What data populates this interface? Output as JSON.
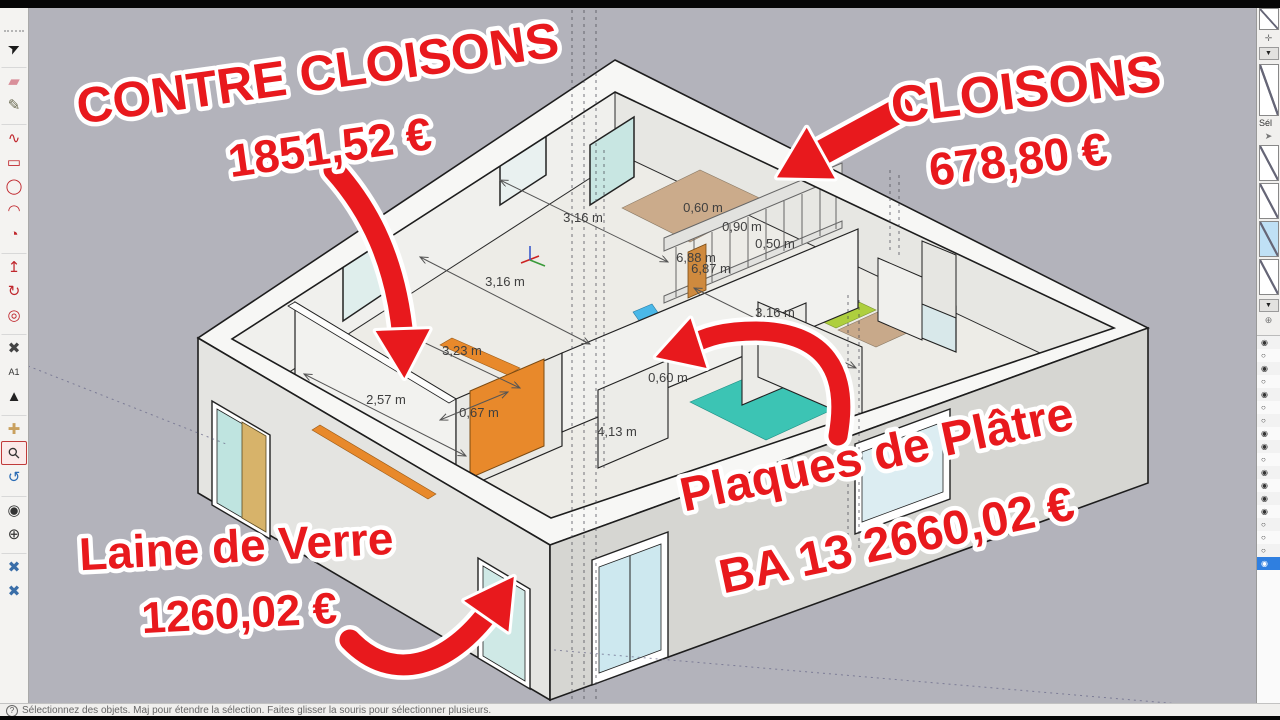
{
  "app": {
    "name": "SketchUp viewport",
    "viewport_bg": "#b3b3bb"
  },
  "colors": {
    "annotation_red": "#e8191d",
    "door_orange": "#e8892b",
    "floor_teal": "#3cc4b4",
    "floor_green": "#aecf3e",
    "floor_tan": "#cbab8b",
    "glass_blue": "#cfe9ec",
    "active_row_blue": "#2f7fe0"
  },
  "annotations": {
    "contre": {
      "title": "CONTRE CLOISONS",
      "price": "1851,52 €"
    },
    "cloisons": {
      "title": "CLOISONS",
      "price": "678,80 €"
    },
    "plaques": {
      "title": "Plaques de Plâtre",
      "price": "BA 13 2660,02 €"
    },
    "laine": {
      "title": "Laine de Verre",
      "price": "1260,02 €"
    }
  },
  "dimensions": [
    {
      "label": "3,16 m",
      "x": 583,
      "y": 222
    },
    {
      "label": "3,16 m",
      "x": 505,
      "y": 286
    },
    {
      "label": "3,16 m",
      "x": 775,
      "y": 317
    },
    {
      "label": "0,60 m",
      "x": 703,
      "y": 212
    },
    {
      "label": "0,90 m",
      "x": 742,
      "y": 231
    },
    {
      "label": "0,50 m",
      "x": 775,
      "y": 248
    },
    {
      "label": "6,88 m",
      "x": 696,
      "y": 262
    },
    {
      "label": "6,87 m",
      "x": 711,
      "y": 273
    },
    {
      "label": "3,23 m",
      "x": 462,
      "y": 355
    },
    {
      "label": "2,57 m",
      "x": 386,
      "y": 404
    },
    {
      "label": "0,67 m",
      "x": 479,
      "y": 417
    },
    {
      "label": "0,60 m",
      "x": 668,
      "y": 382
    },
    {
      "label": "4,13 m",
      "x": 617,
      "y": 436
    }
  ],
  "toolbar": {
    "tools": [
      {
        "name": "select",
        "glyph": "➤",
        "color": "#1a1a1a",
        "rotate": -25
      },
      {
        "name": "eraser",
        "glyph": "▰",
        "color": "#d98f9a",
        "gap": true
      },
      {
        "name": "paint",
        "glyph": "✎",
        "color": "#6b6b52"
      },
      {
        "name": "freehand-line",
        "glyph": "∿",
        "color": "#c0272d",
        "gap": true
      },
      {
        "name": "rectangle",
        "glyph": "▭",
        "color": "#c0272d"
      },
      {
        "name": "circle",
        "glyph": "◯",
        "color": "#c0272d"
      },
      {
        "name": "arc",
        "glyph": "◠",
        "color": "#c0272d"
      },
      {
        "name": "pie",
        "glyph": "◔",
        "color": "#c0272d"
      },
      {
        "name": "push-pull",
        "glyph": "↥",
        "color": "#c0272d",
        "gap": true
      },
      {
        "name": "follow-me",
        "glyph": "↻",
        "color": "#c0272d"
      },
      {
        "name": "offset",
        "glyph": "◎",
        "color": "#c0272d"
      },
      {
        "name": "tape-measure",
        "glyph": "✖",
        "color": "#444444",
        "gap": true
      },
      {
        "name": "text",
        "glyph": "A1",
        "color": "#333333",
        "small": true
      },
      {
        "name": "axes",
        "glyph": "▲",
        "color": "#222222"
      },
      {
        "name": "pan",
        "glyph": "✚",
        "color": "#c9a05e",
        "gap": true
      },
      {
        "name": "zoom",
        "glyph": "⚲",
        "color": "#333333",
        "rotate": -45,
        "selected": true
      },
      {
        "name": "orbit",
        "glyph": "↺",
        "color": "#2b6cb5"
      },
      {
        "name": "look-around",
        "glyph": "◉",
        "color": "#333333",
        "gap": true
      },
      {
        "name": "position-camera",
        "glyph": "⊕",
        "color": "#333333"
      },
      {
        "name": "section-plane",
        "glyph": "✖",
        "color": "#3a6ea8",
        "gap": true
      },
      {
        "name": "section-settings",
        "glyph": "✖",
        "color": "#3a6ea8"
      }
    ]
  },
  "right_panel": {
    "section_label": "Sél",
    "dropdown_glyph": "▼",
    "move_glyph": "✛",
    "cursor_glyph": "➤",
    "circle_glyph": "⊕",
    "scenes": [
      {
        "sky": false
      },
      {
        "sky": false
      },
      {
        "sky": true
      },
      {
        "sky": false
      }
    ],
    "tags": {
      "rows": [
        {
          "on": true
        },
        {
          "on": false
        },
        {
          "on": true
        },
        {
          "on": false
        },
        {
          "on": true
        },
        {
          "on": false
        },
        {
          "on": false
        },
        {
          "on": true
        },
        {
          "on": true
        },
        {
          "on": false
        },
        {
          "on": true
        },
        {
          "on": true
        },
        {
          "on": true
        },
        {
          "on": true
        },
        {
          "on": false
        },
        {
          "on": false
        },
        {
          "on": false
        },
        {
          "on": true,
          "active": true
        }
      ]
    }
  },
  "status_bar": {
    "icon": "?",
    "hint": "Sélectionnez des objets. Maj pour étendre la sélection. Faites glisser la souris pour sélectionner plusieurs."
  }
}
